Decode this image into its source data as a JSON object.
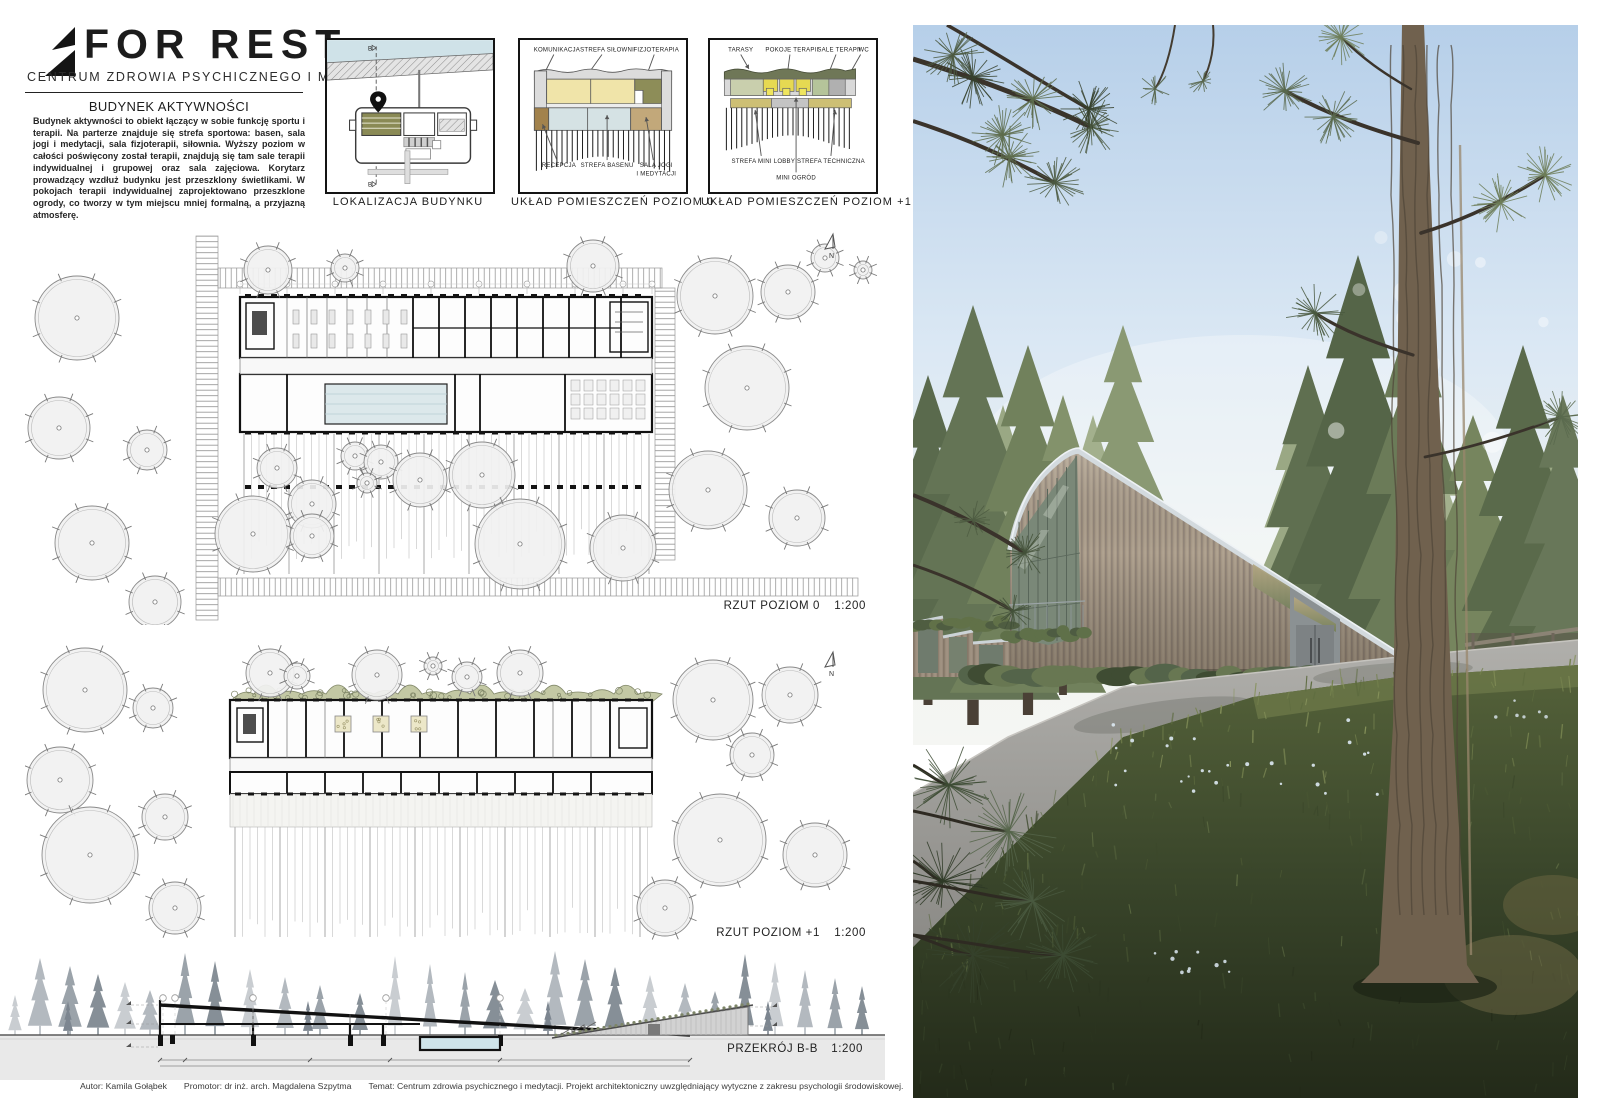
{
  "logo": {
    "title": "FOR REST",
    "subtitle": "CENTRUM ZDROWIA PSYCHICZNEGO I MEDYTACJI"
  },
  "intro": {
    "heading": "BUDYNEK AKTYWNOŚCI",
    "body": "Budynek aktywności to obiekt łączący w sobie funkcję sportu i terapii. Na parterze znajduje się strefa sportowa: basen, sala jogi i medytacji, sala fizjoterapii, siłownia. Wyższy poziom w całości poświęcony został terapii, znajdują się tam sale terapii indywidualnej i grupowej oraz sala zajęciowa. Korytarz prowadzący wzdłuż budynku jest przeszklony świetlikami. W pokojach terapii indywidualnej zaprojektowano przeszklone ogrody, co tworzy w tym miejscu mniej formalną, a przyjazną atmosferę."
  },
  "diagrams": {
    "location": {
      "caption": "LOKALIZACJA BUDYNKU",
      "marker_top": "B",
      "marker_bottom": "B"
    },
    "level0": {
      "caption": "UKŁAD POMIESZCZEŃ POZIOM 0",
      "top_labels": [
        "KOMUNIKACJA",
        "STREFA SIŁOWNI",
        "FIZJOTERAPIA"
      ],
      "bottom_labels": [
        "RECEPCJA",
        "STREFA BASENU",
        "SALA JOGI",
        "I MEDYTACJI"
      ]
    },
    "level1": {
      "caption": "UKŁAD POMIESZCZEŃ POZIOM +1",
      "top_labels": [
        "TARASY",
        "POKOJE TERAPII",
        "SALE TERAPII",
        "WC"
      ],
      "bottom_labels": [
        "STREFA MINI LOBBY",
        "STREFA TECHNICZNA",
        "MINI OGRÓD"
      ]
    }
  },
  "plans": {
    "north": "N",
    "level0": {
      "label": "RZUT POZIOM 0",
      "scale": "1:200"
    },
    "level1": {
      "label": "RZUT POZIOM +1",
      "scale": "1:200"
    },
    "section": {
      "label": "PRZEKRÓJ B-B",
      "scale": "1:200"
    }
  },
  "footer": {
    "author": "Autor: Kamila Gołąbek",
    "promoter": "Promotor: dr inż. arch. Magdalena Szpytma",
    "topic": "Temat: Centrum zdrowia psychicznego i medytacji. Projekt architektoniczny uwzględniający wytyczne z zakresu psychologii środowiskowej.",
    "semester": "Sem. VII",
    "year": "Rok akademicki 2020/21",
    "university": "Politechnika Rzeszowska",
    "sheet": "Plansza 4"
  },
  "colors": {
    "paper": "#ffffff",
    "ink": "#1c1c1c",
    "water": "#cfe2e8",
    "tree_fill": "#f1f1f1",
    "d0_yellow": "#f0e4a9",
    "d0_blue": "#d5e2e4",
    "d0_olive": "#8d8d58",
    "d0_tan": "#c2a87a",
    "d0_brown": "#a2824c",
    "d0_gray": "#dcdcdc",
    "d1_green": "#6f7757",
    "d1_yellow": "#e6d952",
    "d1_sage": "#c9cfad",
    "d1_palegreen": "#b5c49a",
    "d1_gray": "#b9b9b9",
    "d1_khaki": "#cdbf74",
    "sec_ground": "#e9e9e9",
    "sec_pool": "#cfe4ea",
    "ph_sky": "#b6cfe9",
    "ph_wood": "#a89a88",
    "ph_pine": "#4c5a41",
    "ph_road": "#a09f9b",
    "ph_meadow": "#3c4630",
    "ph_roofcap": "#d3dade"
  }
}
